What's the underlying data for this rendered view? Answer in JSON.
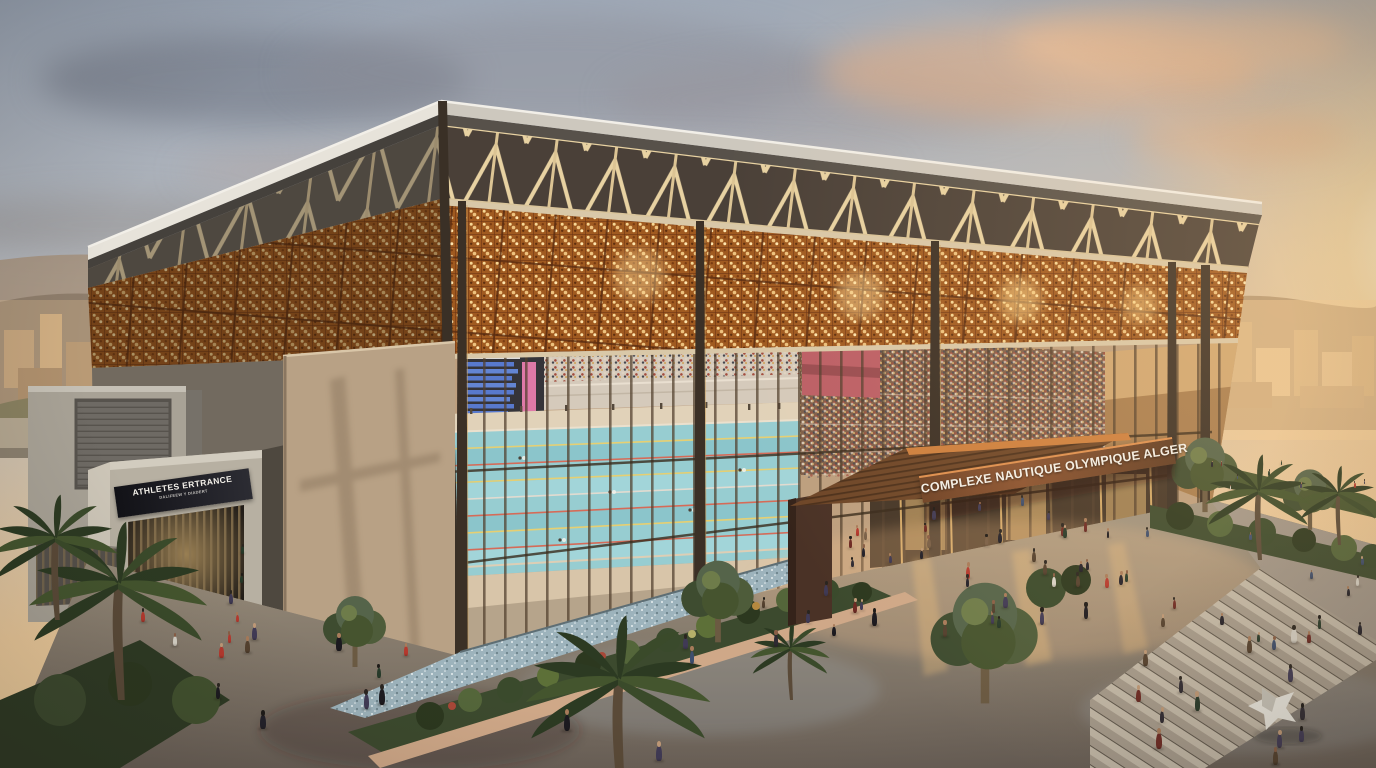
{
  "signs": {
    "main_canopy": "COMPLEXE NAUTIQUE OLYMPIQUE ALGER",
    "athletes_entrance": "ATHLETES ERTRANCE",
    "athletes_entrance_subtext": "DALIFEEW Y DIADERT"
  },
  "colors": {
    "mashrabiya_copper": "#a05a20",
    "sunset_sky": "#f6d7a1",
    "pool_water": "#86ccd9",
    "canopy_wood": "#6e4628",
    "concrete": "#b7b0a2",
    "steel_truss": "#e8d2a2",
    "banner_red": "#b24c5c"
  }
}
